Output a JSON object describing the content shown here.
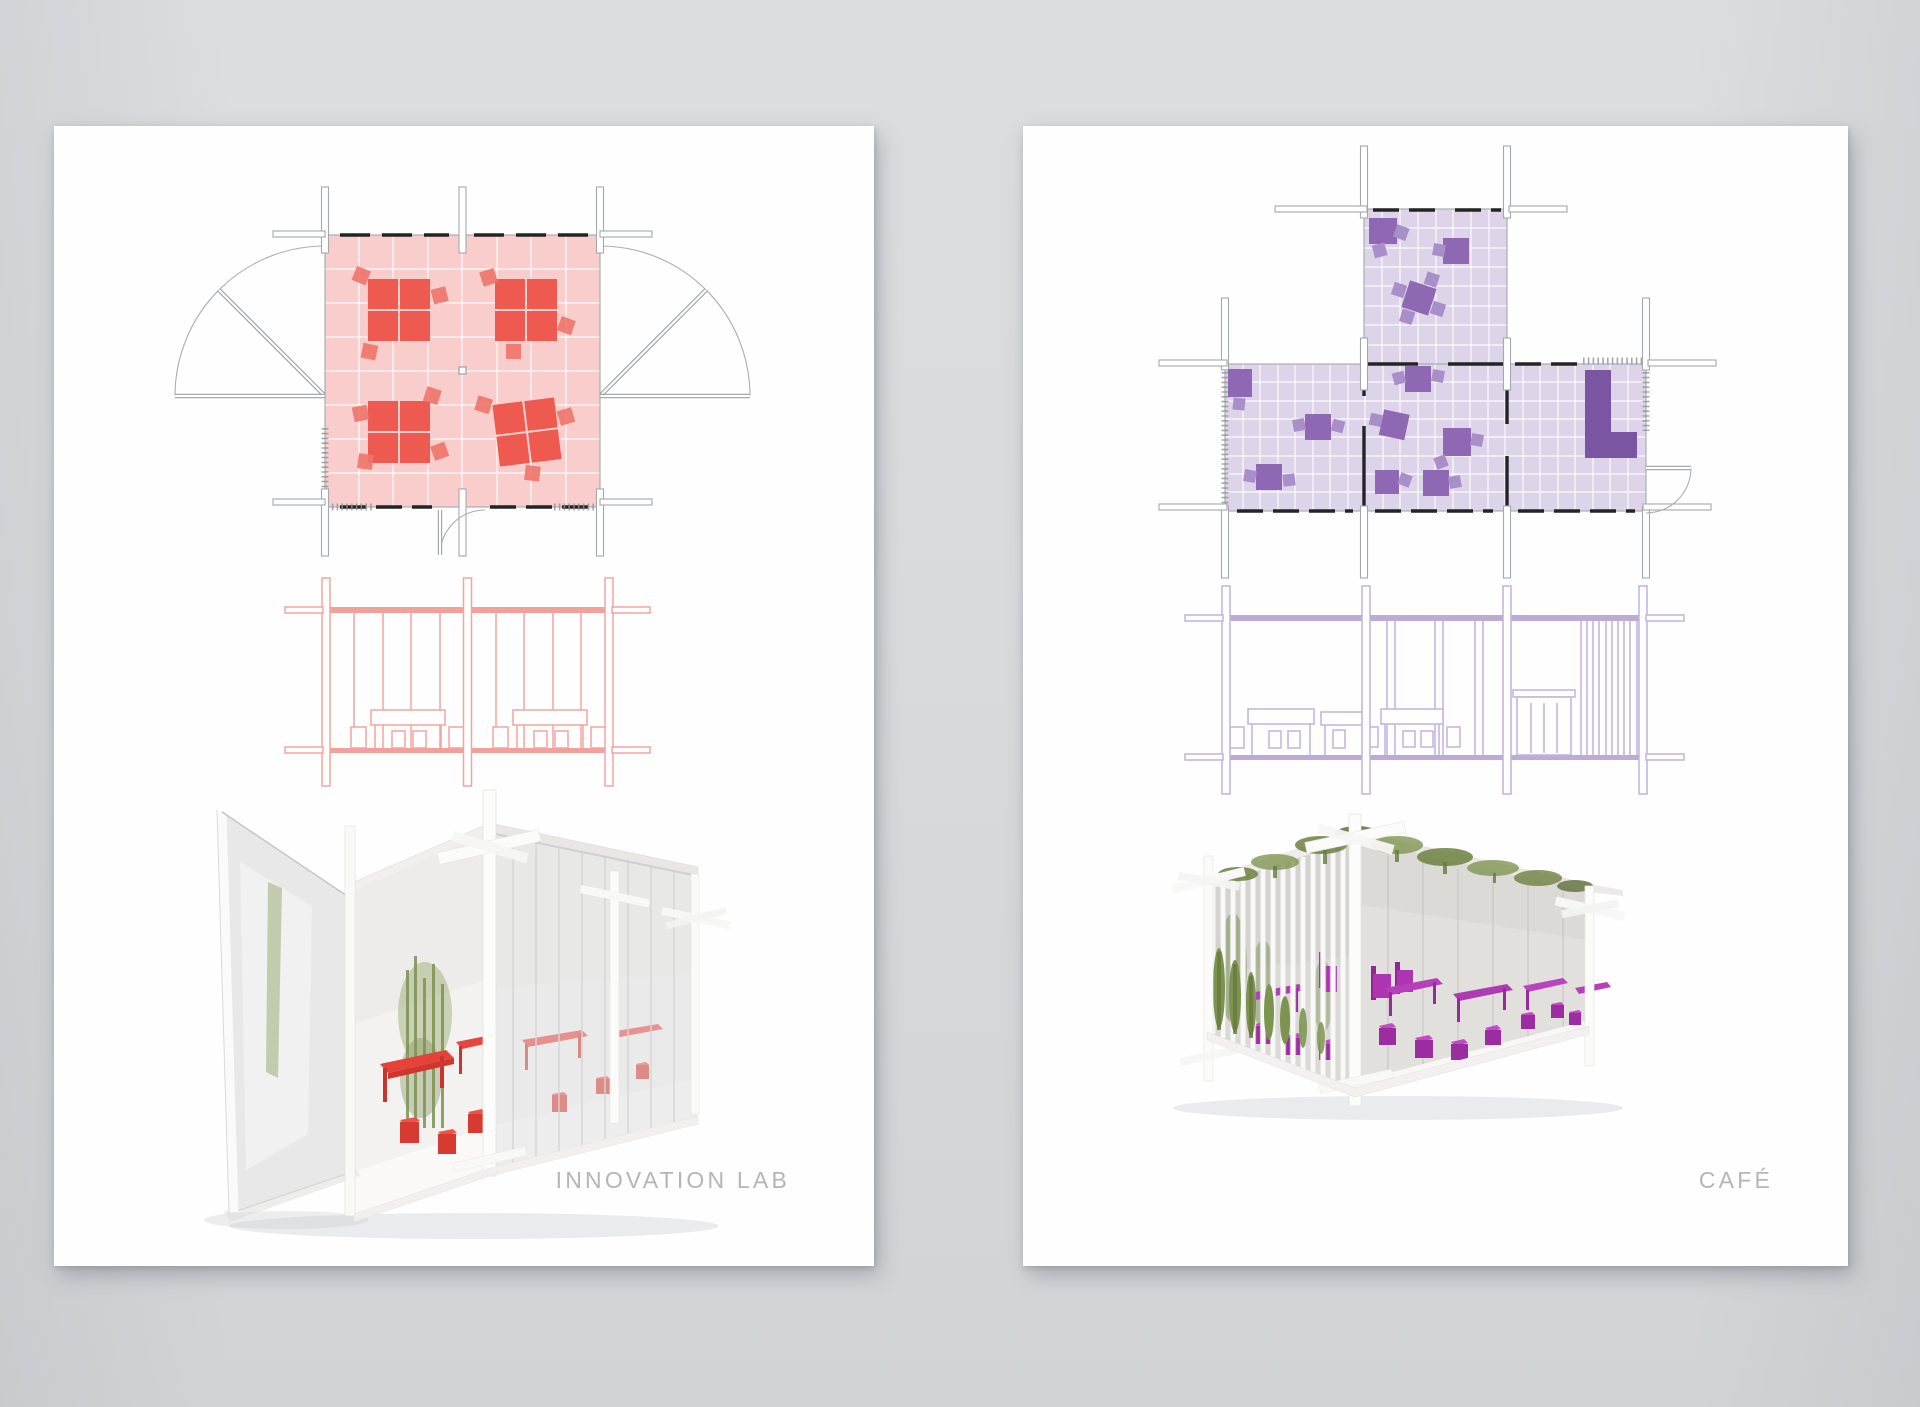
{
  "canvas": {
    "background_top": "#dbdee1",
    "background_bottom": "#d1d4d7",
    "board_color": "#fefefe"
  },
  "boards": [
    {
      "id": "innovation-lab",
      "label": "INNOVATION LAB",
      "accent_color": "#e8514a",
      "plan_fill_color": "#f9cdcb",
      "plan_furniture_color": "#ee5a50",
      "elevation_line_color": "#f3a49f",
      "render_furniture_color": "#e2382f",
      "views": [
        "floor-plan",
        "elevation",
        "perspective-render"
      ]
    },
    {
      "id": "cafe",
      "label": "CAFÉ",
      "accent_color": "#8f68b4",
      "plan_fill_color": "#ded4e9",
      "plan_furniture_color": "#8f68b4",
      "plan_counter_color": "#7a56a2",
      "elevation_line_color": "#c3b1dc",
      "render_furniture_color": "#b23db6",
      "render_plant_color": "#7d9450",
      "views": [
        "floor-plan",
        "elevation",
        "perspective-render"
      ]
    }
  ]
}
